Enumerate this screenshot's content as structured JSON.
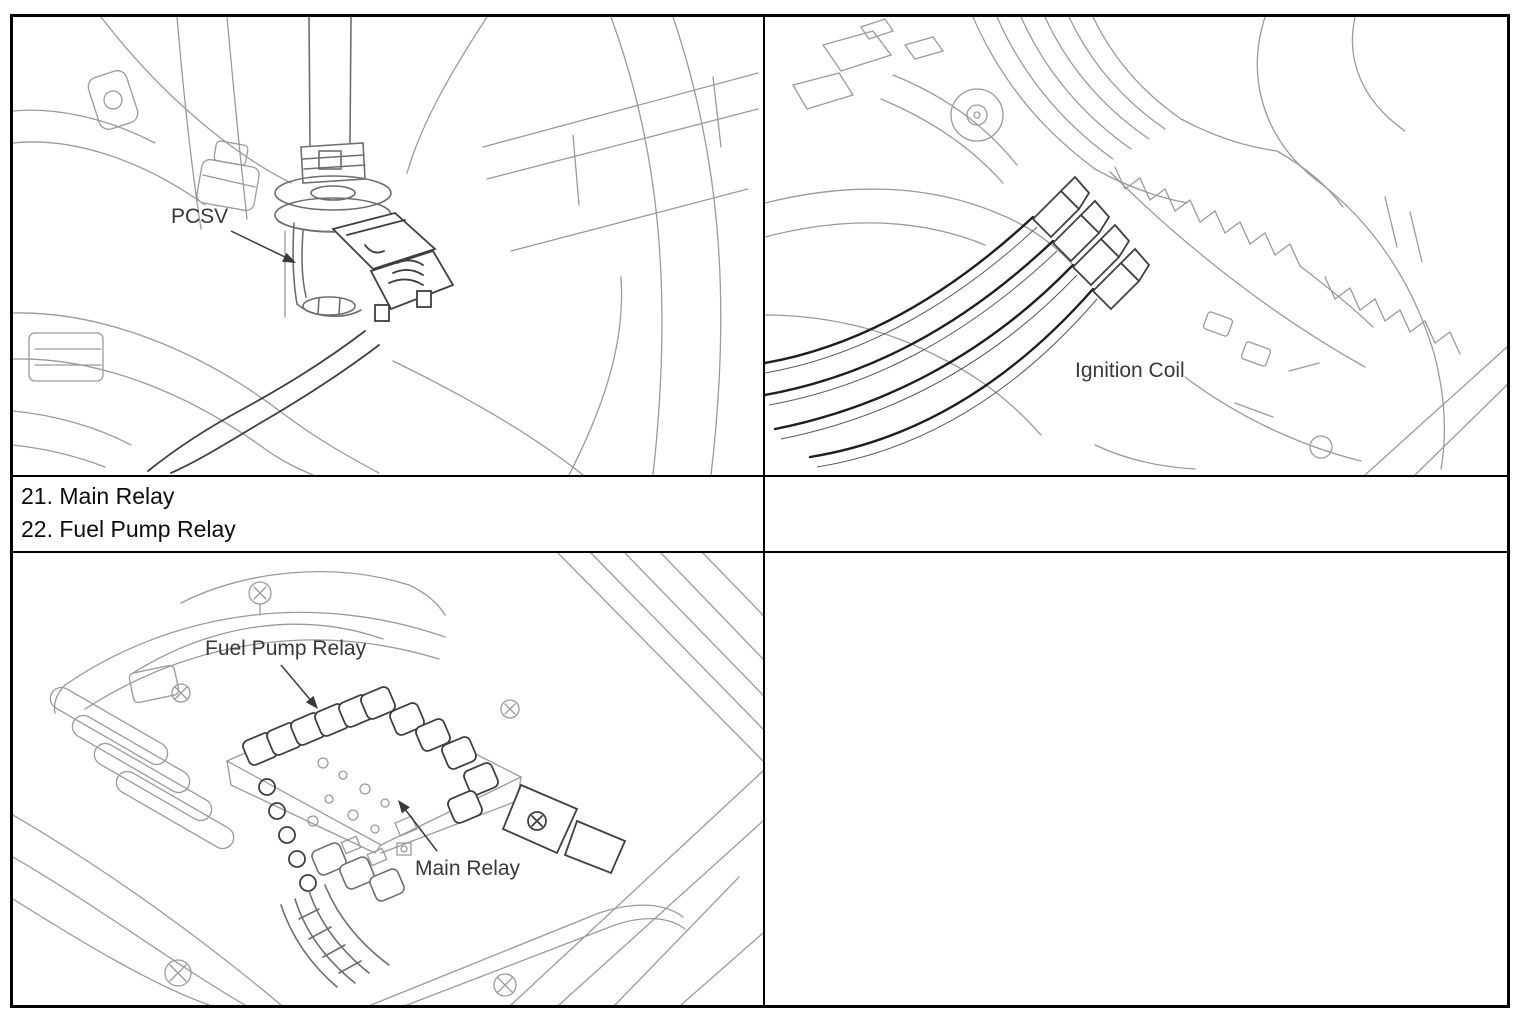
{
  "page": {
    "background": "#ffffff",
    "table_border_color": "#000000",
    "art_light_color": "#9a9a9a",
    "art_dark_color": "#3f3f3f",
    "callout_color": "#383838",
    "text_color": "#0d0d0d"
  },
  "figures": {
    "pcsv": {
      "callout": "PCSV"
    },
    "ignition_coil": {
      "callout": "Ignition Coil"
    },
    "relay_box": {
      "callout_fuel_pump": "Fuel Pump Relay",
      "callout_main": "Main Relay"
    }
  },
  "legend": {
    "items": [
      {
        "text": "21. Main Relay"
      },
      {
        "text": "22. Fuel Pump Relay"
      }
    ]
  }
}
